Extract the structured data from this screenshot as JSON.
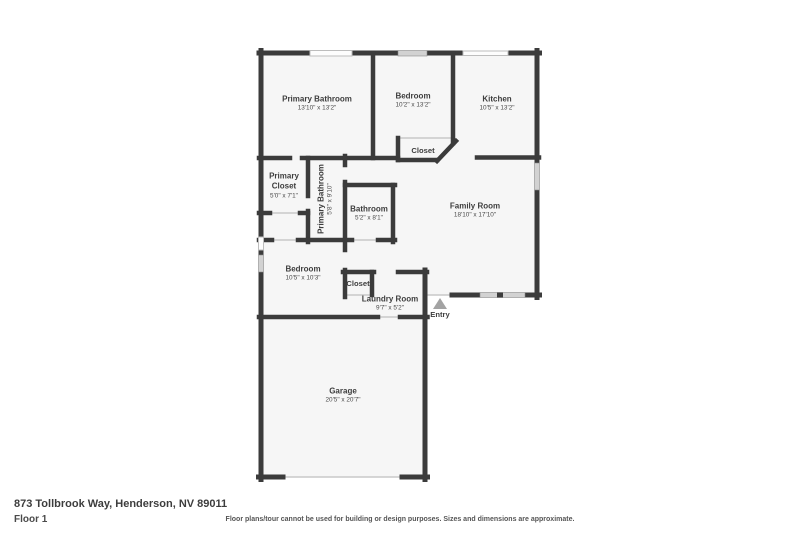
{
  "address": "873 Tollbrook Way, Henderson, NV 89011",
  "floor_label": "Floor 1",
  "disclaimer": "Floor plans/tour cannot be used for building or design purposes. Sizes and dimensions are approximate.",
  "entry": {
    "label": "Entry"
  },
  "colors": {
    "wall": "#3b3b3b",
    "room_fill": "#f6f6f6",
    "window_gray": "#d2d2d2",
    "window_white": "#fdfdfd",
    "text": "#3d3d3d",
    "entry_arrow": "#a3a3a3"
  },
  "rooms": [
    {
      "name": "Primary Bathroom",
      "dims": "13'10\" x 13'2\""
    },
    {
      "name": "Bedroom",
      "dims": "10'2\" x 13'2\""
    },
    {
      "name": "Kitchen",
      "dims": "10'5\" x 13'2\""
    },
    {
      "name": "Closet",
      "dims": ""
    },
    {
      "name": "Primary Closet",
      "dims": "5'0\" x 7'1\""
    },
    {
      "name": "Primary Bathroom",
      "dims": "5'8\" x 9'10\""
    },
    {
      "name": "Bathroom",
      "dims": "5'2\" x 8'1\""
    },
    {
      "name": "Family Room",
      "dims": "18'10\" x 17'10\""
    },
    {
      "name": "Bedroom",
      "dims": "10'5\" x 10'3\""
    },
    {
      "name": "Closet",
      "dims": ""
    },
    {
      "name": "Laundry Room",
      "dims": "9'7\" x 5'2\""
    },
    {
      "name": "Garage",
      "dims": "20'5\" x 20'7\""
    }
  ]
}
